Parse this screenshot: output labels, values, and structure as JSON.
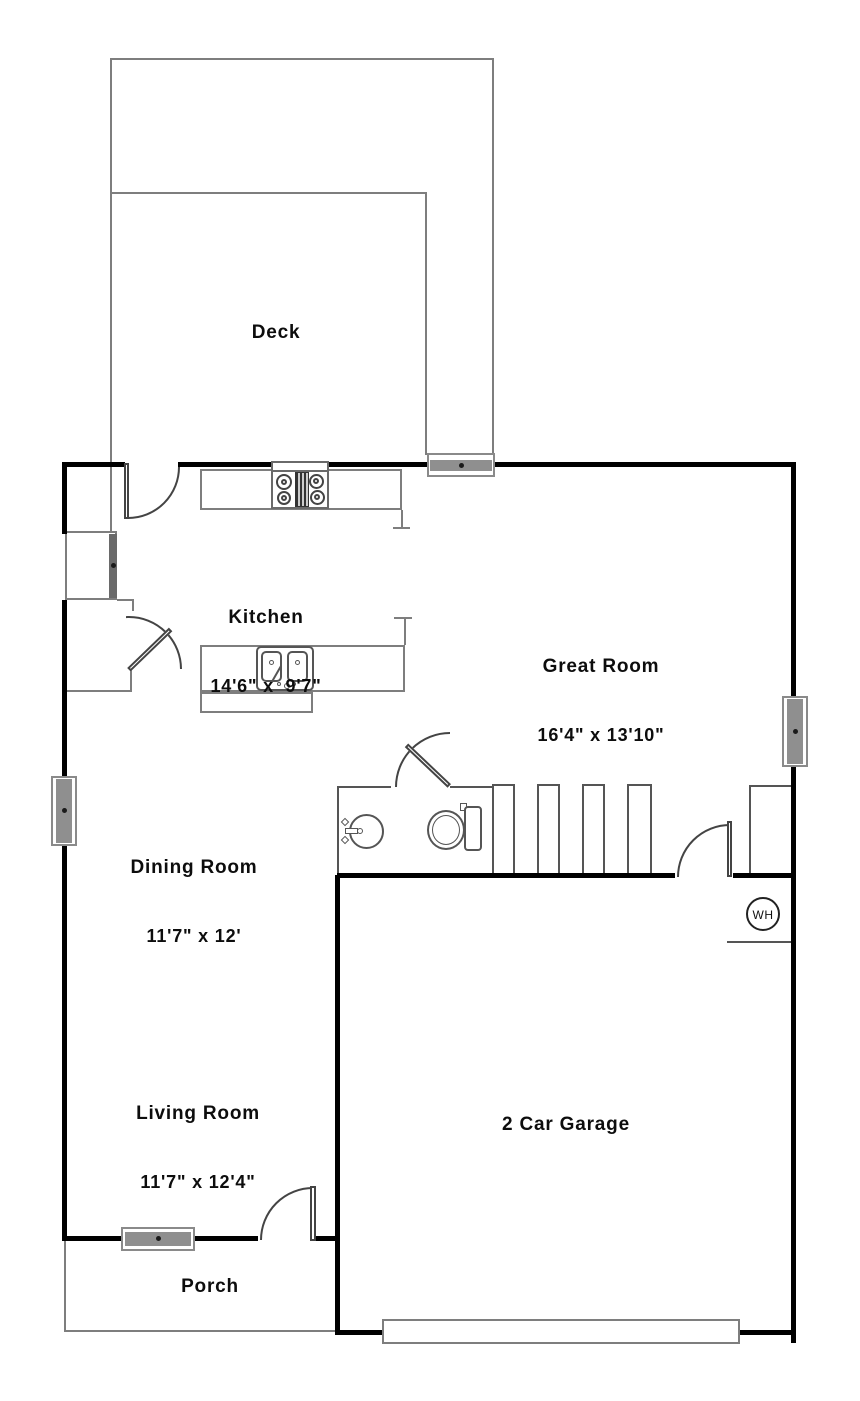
{
  "rooms": {
    "deck": {
      "name": "Deck"
    },
    "kitchen": {
      "name": "Kitchen",
      "dims": "14'6\" x  9'7\""
    },
    "great_room": {
      "name": "Great Room",
      "dims": "16'4\" x 13'10\""
    },
    "dining_room": {
      "name": "Dining Room",
      "dims": "11'7\" x 12'"
    },
    "living_room": {
      "name": "Living Room",
      "dims": "11'7\" x 12'4\""
    },
    "garage": {
      "name": "2 Car Garage"
    },
    "porch": {
      "name": "Porch"
    }
  },
  "fixtures": {
    "water_heater": "WH"
  },
  "colors": {
    "wall": "#000000",
    "thin_line": "#7e7e7e",
    "door_line": "#444444",
    "glazing": "#8f8f8f",
    "text": "#0d0d0d",
    "background": "#ffffff"
  }
}
